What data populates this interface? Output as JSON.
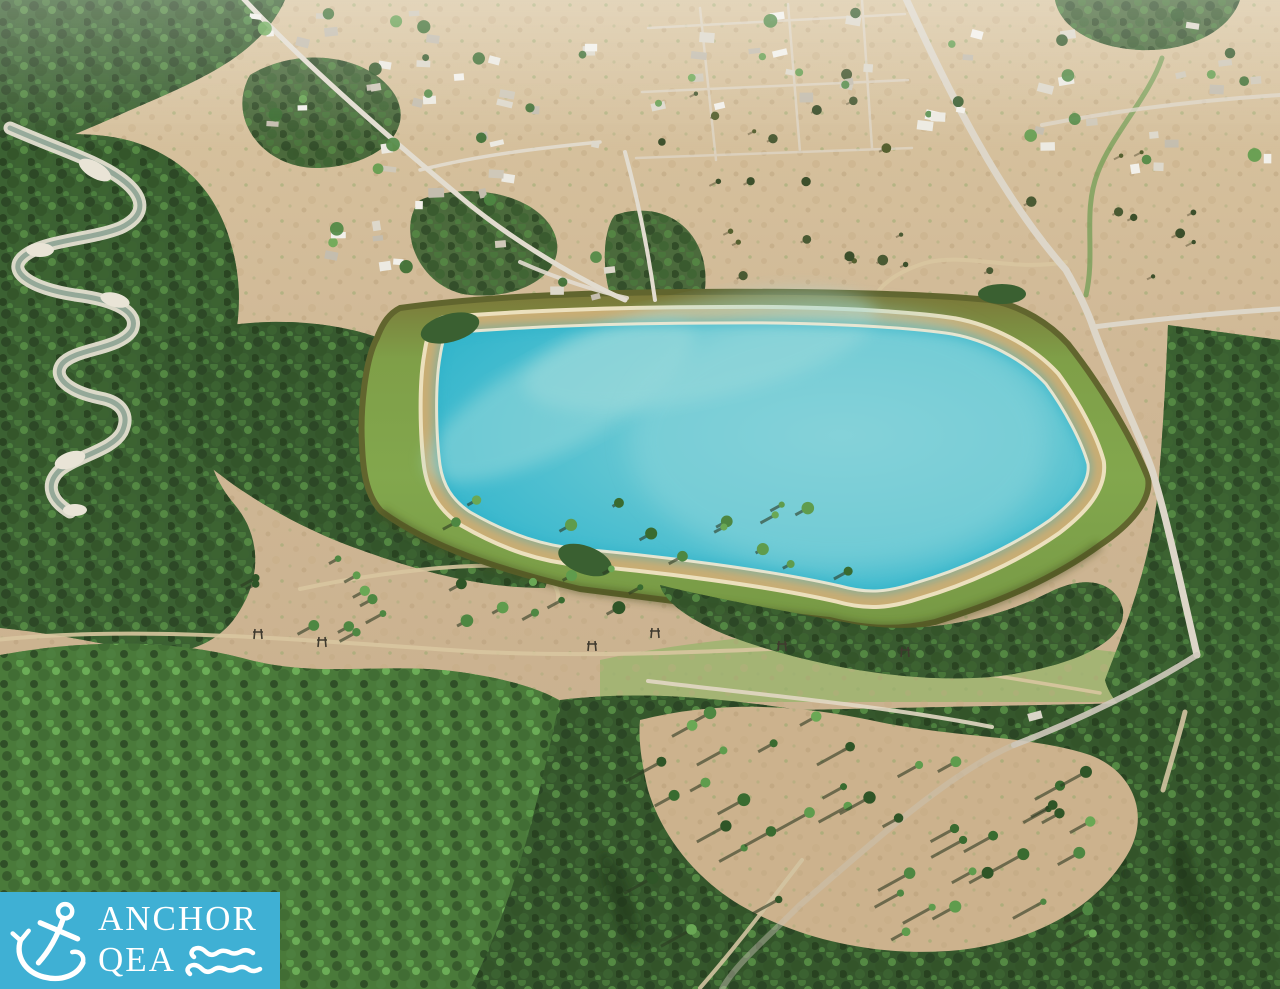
{
  "logo": {
    "company_line1": "ANCHOR",
    "company_line2": "QEA",
    "background_color": "#3FB0D4",
    "text_color": "#FFFFFF"
  },
  "colors": {
    "reservoir_water_edge": "#2EB3CA",
    "reservoir_water_center": "#7FD0D8",
    "embankment_green": "#82A74D",
    "embankment_edge_dark": "#61652E",
    "rim_tan": "#C9AD74",
    "rim_highlight": "#ECE0BD",
    "field_tan": "#CFB795",
    "grass_green": "#A4B474",
    "forest_dark": "#3B6132",
    "forest_bright": "#4A7A3A",
    "road_light": "#DDD6C8",
    "trail_tan": "#D9C7A0",
    "river_gravel": "#E4DFD1",
    "river_water": "#94A898"
  }
}
